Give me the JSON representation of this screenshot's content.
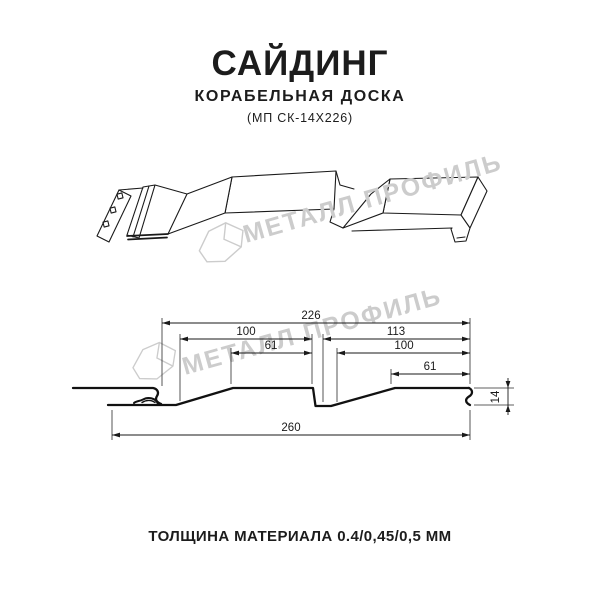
{
  "header": {
    "title": "САЙДИНГ",
    "subtitle": "КОРАБЕЛЬНАЯ ДОСКА",
    "code": "(МП СК-14Х226)"
  },
  "watermark": {
    "text": "МЕТАЛЛ ПРОФИЛЬ",
    "color": "#cccccc",
    "logo_icon": "metall-profil-logo"
  },
  "diagram": {
    "line_color": "#1a1a1a",
    "dimensions": {
      "total_width": "260",
      "panel_cover_width": "226",
      "left_board_width": "100",
      "left_board_top": "61",
      "right_section_width": "113",
      "right_board_width": "100",
      "right_board_top": "61",
      "profile_height": "14"
    }
  },
  "footer": {
    "caption": "ТОЛЩИНА МАТЕРИАЛА 0.4/0,45/0,5 ММ"
  }
}
